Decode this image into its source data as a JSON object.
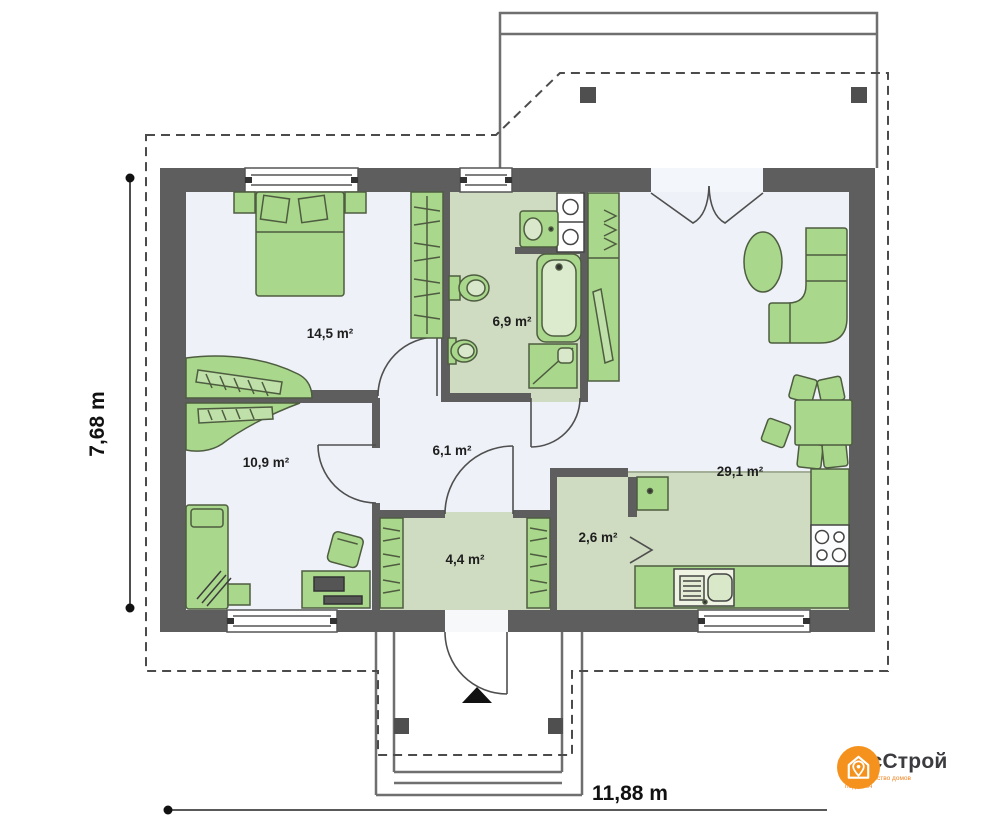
{
  "plan": {
    "rooms": [
      {
        "name": "bedroom",
        "area": "14,5 m²"
      },
      {
        "name": "bathroom",
        "area": "6,9 m²"
      },
      {
        "name": "second-bedroom",
        "area": "10,9 m²"
      },
      {
        "name": "hall",
        "area": "6,1 m²"
      },
      {
        "name": "entry",
        "area": "4,4 m²"
      },
      {
        "name": "pantry",
        "area": "2,6 m²"
      },
      {
        "name": "living-kitchen",
        "area": "29,1 m²"
      }
    ],
    "dimensions": {
      "height": "7,68 m",
      "width": "11,88 m"
    }
  },
  "logo": {
    "brand": "РусСтрой",
    "tagline_line1": "Строительство домов",
    "tagline_line2": "под ключ"
  },
  "colors": {
    "wall": "#5e5e5e",
    "floor_light": "#eef2f8",
    "floor_green": "#cfdcc1",
    "furniture_green": "#a9d78c",
    "furniture_stroke": "#4e5c40",
    "accent_orange": "#f5921e"
  }
}
